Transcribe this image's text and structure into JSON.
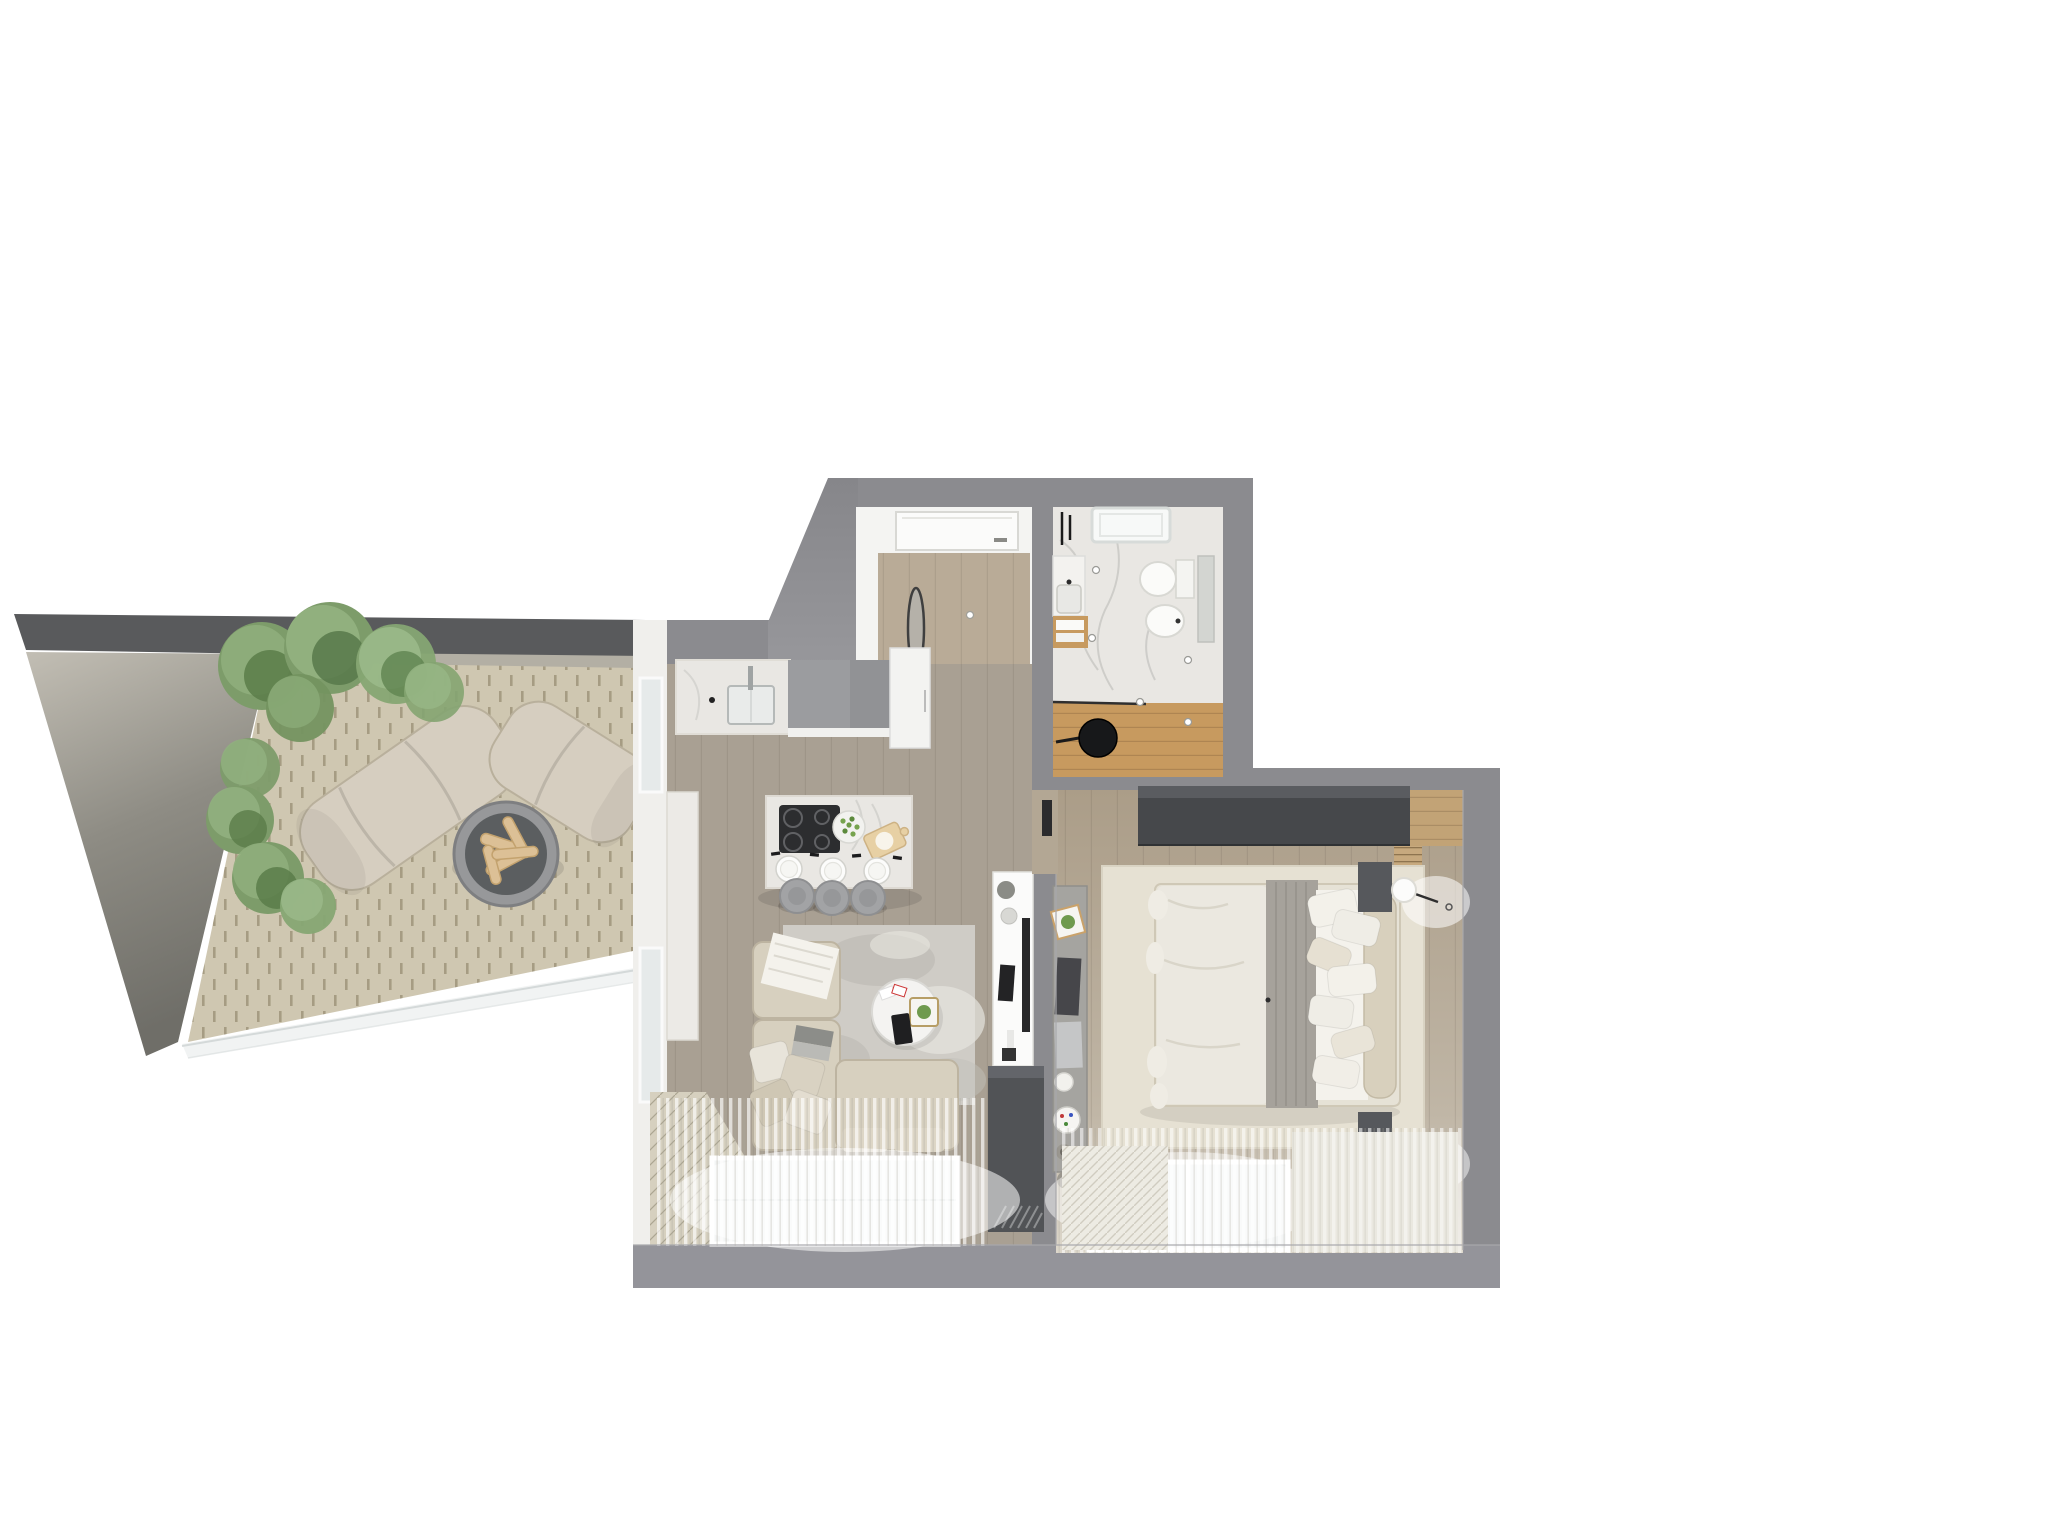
{
  "scene": {
    "kind": "3d-floor-plan-top-view-render",
    "background": "#ffffff",
    "visible_text": "none"
  },
  "palette": {
    "bg": "#ffffff",
    "wall": "#8b8b8f",
    "wall_inner": "#9a9a9e",
    "terrace_cap": "#595a5c",
    "terrace_ledge": "#b3afa4",
    "terrace_floor": "#cfc7b1",
    "concrete_light": "#c2beb4",
    "concrete_dark": "#6f6e68",
    "plant_green": "#7d9c6a",
    "plant_green_dark": "#5a7c49",
    "lounge_fabric": "#d6cec0",
    "firepit_rim": "#97989a",
    "firepit_bowl": "#5b5e60",
    "log_wood": "#dcc096",
    "floor_living": "#a9a093",
    "floor_entry": "#b9ab97",
    "floor_bedroom": "#b3a794",
    "marble": "#e9e7e3",
    "bath_wood": "#c79a5f",
    "sofa": "#d7d0bf",
    "rug_living": "#cfccc6",
    "rug_bedroom": "#e6e1d3",
    "wardrobe": "#46484b",
    "cabinet_dark": "#515356",
    "slat_wood": "#c7a97e",
    "cooktop": "#2c2d2f",
    "stool": "#a2a3a5",
    "duvet": "#ebe8e0",
    "blanket_gray": "#a6a29b",
    "window_glass": "#f3f5f5"
  },
  "rooms": [
    {
      "id": "terrace",
      "label": "terrace",
      "furniture": [
        "concrete parapet wall",
        "six green shrubs",
        "curved lounge chair large",
        "curved lounge chair small",
        "round fire pit with logs",
        "glass railing",
        "stone tile paving"
      ]
    },
    {
      "id": "entry-hall",
      "label": "entry hall",
      "furniture": [
        "entrance door",
        "oval leaning mirror",
        "ceiling spotlights",
        "wood plank floor"
      ]
    },
    {
      "id": "bathroom",
      "label": "bathroom",
      "furniture": [
        "shower tray skylight",
        "toilet",
        "bidet",
        "vanity with sink",
        "wood shelf with towels",
        "wall mirror panel",
        "glass shower partition",
        "round black mirror",
        "wood floor zone",
        "marble tile floor",
        "black wall faucets",
        "ceiling spotlights"
      ]
    },
    {
      "id": "kitchen",
      "label": "kitchen",
      "furniture": [
        "marble countertop with sink",
        "faucet",
        "gray upper cabinet",
        "tall white cabinet",
        "marble kitchen island",
        "induction cooktop",
        "salad bowl",
        "cutting board with dough",
        "three place settings",
        "three round stools"
      ]
    },
    {
      "id": "living-room",
      "label": "living room",
      "furniture": [
        "l-shaped sectional sofa",
        "white throw blanket",
        "laptop on sofa",
        "four scatter pillows",
        "round marble coffee table",
        "playing cards",
        "tray with plant",
        "black tablet",
        "distressed gray rug",
        "tv console with tv",
        "black speaker",
        "dark storage cabinet",
        "sheer curtains",
        "bottom windows",
        "side window wall",
        "white sideboard",
        "diagonal wood deck strip"
      ]
    },
    {
      "id": "bedroom",
      "label": "bedroom",
      "furniture": [
        "dark wardrobe",
        "double bed",
        "white duvet",
        "gray runner blanket",
        "seven pillows",
        "bolster cushion",
        "wood slat headboard wall",
        "two dark nightstands",
        "two round wall lamps",
        "cream area rug",
        "wall desk with monitor and laptop",
        "picture frame with plant",
        "two pleated white rugs",
        "sheer curtains",
        "bottom window"
      ]
    }
  ]
}
